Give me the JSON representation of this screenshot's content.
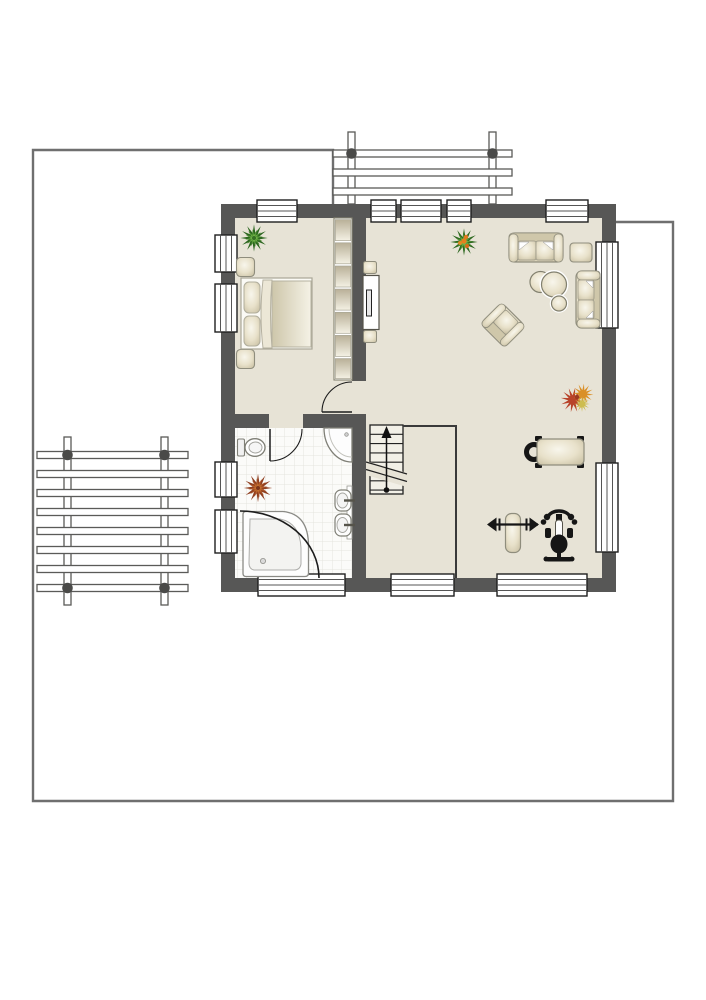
{
  "colors": {
    "wall": "#575756",
    "floor": "#e7e3d6",
    "stair_floor": "#f2f0e7",
    "boundary": "#6f6f6f",
    "tile": "#fbfbf9",
    "tile_line": "#e4e4de",
    "furniture_stroke": "#8f8d7d",
    "fixture_stroke": "#7f7f76",
    "black_equipment": "#161616",
    "window_frame": "#1f1f1f",
    "plant_green": "#2c661f",
    "plant_rust": "#8f3e1f",
    "plant_autumn": "#b8432a"
  },
  "plan": {
    "site": {
      "boundary_shape": "property-line",
      "structures": [
        "left-pergola-deck",
        "top-balcony-railing"
      ]
    },
    "rooms": [
      {
        "name": "bedroom",
        "furniture": [
          "double-bed",
          "nightstand",
          "nightstand",
          "shelf-wardrobe",
          "green-plant"
        ]
      },
      {
        "name": "living-room",
        "furniture": [
          "sofa",
          "loveseat",
          "armchair",
          "round-table-set",
          "side-table",
          "tv-sideboard",
          "flowering-plant",
          "autumn-plant"
        ]
      },
      {
        "name": "fitness-corner",
        "furniture": [
          "weight-bench",
          "barbell-bench",
          "exercise-bike"
        ]
      },
      {
        "name": "bathroom",
        "furniture": [
          "corner-bathtub",
          "corner-shower",
          "toilet",
          "washbasin",
          "washbasin",
          "rust-plant"
        ]
      },
      {
        "name": "hall",
        "furniture": [
          "staircase"
        ]
      }
    ],
    "stairs": {
      "steps": 7,
      "direction": "up-arrow",
      "break_symbol": true
    },
    "doors": [
      "bedroom-door",
      "bathroom-door"
    ],
    "windows": {
      "top_wall": 5,
      "bottom_wall": 3,
      "left_wall": 4,
      "right_wall": 2
    }
  }
}
